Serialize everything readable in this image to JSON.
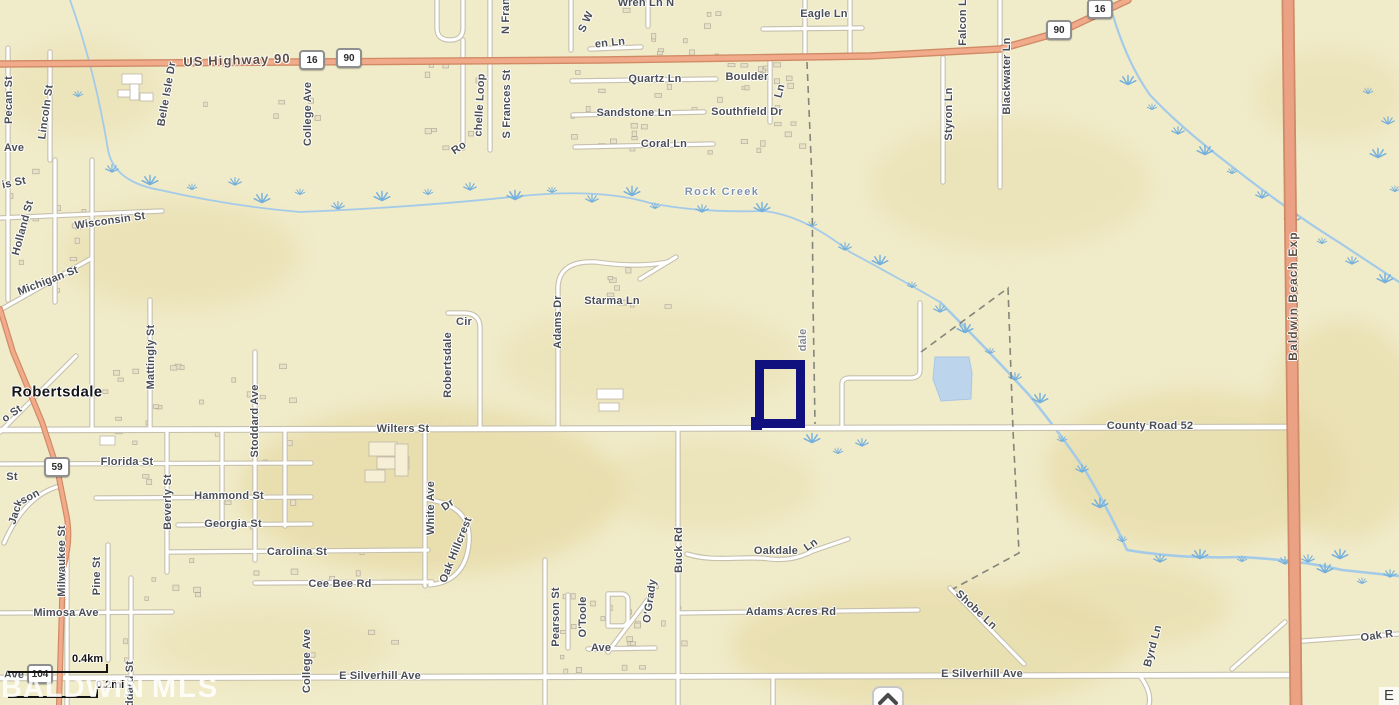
{
  "map": {
    "background_color": "#f0ebc9",
    "parcel_color": "#10107e",
    "pond_color": "#bdd4ed",
    "highway_color": "#f1ab8a",
    "labels": [
      {
        "t": "US Highway 90",
        "x": 237,
        "y": 60,
        "r": -2,
        "c": "hwy",
        "s": 13
      },
      {
        "t": "Pecan St",
        "x": 9,
        "y": 100,
        "r": -90
      },
      {
        "t": "Ave",
        "x": 14,
        "y": 148,
        "r": 0
      },
      {
        "t": "Lincoln St",
        "x": 46,
        "y": 112,
        "r": -82
      },
      {
        "t": "Belle Isle Dr",
        "x": 167,
        "y": 94,
        "r": -80
      },
      {
        "t": "is St",
        "x": 14,
        "y": 183,
        "r": -12
      },
      {
        "t": "Holland St",
        "x": 23,
        "y": 228,
        "r": -75
      },
      {
        "t": "Wisconsin St",
        "x": 110,
        "y": 221,
        "r": -8
      },
      {
        "t": "Michigan St",
        "x": 48,
        "y": 281,
        "r": -21
      },
      {
        "t": "College Ave",
        "x": 308,
        "y": 114,
        "r": -90
      },
      {
        "t": "College Ave",
        "x": 307,
        "y": 661,
        "r": -90
      },
      {
        "t": "Ro",
        "x": 459,
        "y": 148,
        "r": -35
      },
      {
        "t": "chelle Loop",
        "x": 480,
        "y": 105,
        "r": -87
      },
      {
        "t": "S Frances St",
        "x": 507,
        "y": 104,
        "r": -90
      },
      {
        "t": "N Fran",
        "x": 506,
        "y": 16,
        "r": -90
      },
      {
        "t": "S W",
        "x": 586,
        "y": 22,
        "r": -65
      },
      {
        "t": "en Ln",
        "x": 610,
        "y": 43,
        "r": -6
      },
      {
        "t": "Wren Ln N",
        "x": 646,
        "y": 3,
        "r": 0
      },
      {
        "t": "Eagle Ln",
        "x": 824,
        "y": 14,
        "r": 0
      },
      {
        "t": "Quartz Ln",
        "x": 655,
        "y": 79,
        "r": 0
      },
      {
        "t": "Boulder",
        "x": 747,
        "y": 77,
        "r": 0
      },
      {
        "t": "Ln",
        "x": 780,
        "y": 91,
        "r": -75
      },
      {
        "t": "Sandstone Ln",
        "x": 634,
        "y": 113,
        "r": 0
      },
      {
        "t": "Southfield Dr",
        "x": 747,
        "y": 112,
        "r": 0
      },
      {
        "t": "Coral Ln",
        "x": 664,
        "y": 144,
        "r": 0
      },
      {
        "t": "Styron Ln",
        "x": 949,
        "y": 114,
        "r": -90
      },
      {
        "t": "Blackwater Ln",
        "x": 1007,
        "y": 76,
        "r": -90
      },
      {
        "t": "Falcon Ln",
        "x": 963,
        "y": 19,
        "r": -90
      },
      {
        "t": "Rock Creek",
        "x": 722,
        "y": 192,
        "r": 0,
        "c": "water"
      },
      {
        "t": "Starma Ln",
        "x": 612,
        "y": 301,
        "r": 0
      },
      {
        "t": "Adams Dr",
        "x": 558,
        "y": 322,
        "r": -90
      },
      {
        "t": "Cir",
        "x": 464,
        "y": 322,
        "r": 0
      },
      {
        "t": "Robertsdale",
        "x": 448,
        "y": 365,
        "r": -90
      },
      {
        "t": "dale",
        "x": 803,
        "y": 340,
        "r": -90,
        "c": "faint"
      },
      {
        "t": "Wilters St",
        "x": 403,
        "y": 429,
        "r": 0
      },
      {
        "t": "County Road 52",
        "x": 1150,
        "y": 426,
        "r": 0
      },
      {
        "t": "Baldwin Beach Exp",
        "x": 1293,
        "y": 296,
        "r": -90,
        "c": "hwy",
        "s": 12
      },
      {
        "t": "Robertsdale",
        "x": 57,
        "y": 392,
        "r": 0,
        "c": "city",
        "s": 15
      },
      {
        "t": "o St",
        "x": 12,
        "y": 414,
        "r": -35
      },
      {
        "t": "St",
        "x": 12,
        "y": 477,
        "r": 0
      },
      {
        "t": "Florida St",
        "x": 127,
        "y": 462,
        "r": 0
      },
      {
        "t": "Mattingly St",
        "x": 151,
        "y": 357,
        "r": -90
      },
      {
        "t": "Stoddard Ave",
        "x": 255,
        "y": 421,
        "r": -90
      },
      {
        "t": "Beverly St",
        "x": 168,
        "y": 502,
        "r": -90
      },
      {
        "t": "Hammond St",
        "x": 229,
        "y": 496,
        "r": 0
      },
      {
        "t": "Georgia St",
        "x": 233,
        "y": 524,
        "r": 0
      },
      {
        "t": "Jack",
        "x": 16,
        "y": 512,
        "r": -72
      },
      {
        "t": "son",
        "x": 30,
        "y": 497,
        "r": -28
      },
      {
        "t": "Carolina St",
        "x": 297,
        "y": 552,
        "r": 0
      },
      {
        "t": "Cee Bee Rd",
        "x": 340,
        "y": 584,
        "r": 0
      },
      {
        "t": "Milwaukee St",
        "x": 62,
        "y": 561,
        "r": -90
      },
      {
        "t": "Pine St",
        "x": 97,
        "y": 576,
        "r": -90
      },
      {
        "t": "Mimosa Ave",
        "x": 66,
        "y": 613,
        "r": 0
      },
      {
        "t": "White Ave",
        "x": 431,
        "y": 508,
        "r": -90
      },
      {
        "t": "Oak Hillcrest",
        "x": 456,
        "y": 550,
        "r": -68
      },
      {
        "t": "Dr",
        "x": 448,
        "y": 505,
        "r": -35
      },
      {
        "t": "Pearson St",
        "x": 556,
        "y": 617,
        "r": -90
      },
      {
        "t": "O'Toole",
        "x": 583,
        "y": 617,
        "r": -90
      },
      {
        "t": "Ave",
        "x": 601,
        "y": 648,
        "r": 0
      },
      {
        "t": "O'Grady",
        "x": 650,
        "y": 601,
        "r": -82
      },
      {
        "t": "Buck Rd",
        "x": 679,
        "y": 550,
        "r": -90
      },
      {
        "t": "Oakdale",
        "x": 776,
        "y": 551,
        "r": 0
      },
      {
        "t": "Ln",
        "x": 811,
        "y": 545,
        "r": -35
      },
      {
        "t": "Adams Acres Rd",
        "x": 791,
        "y": 612,
        "r": 0
      },
      {
        "t": "Shobe Ln",
        "x": 976,
        "y": 610,
        "r": 43
      },
      {
        "t": "Byrd Ln",
        "x": 1153,
        "y": 646,
        "r": -75
      },
      {
        "t": "E Silverhill Ave",
        "x": 380,
        "y": 676,
        "r": 0
      },
      {
        "t": "E Silverhill Ave",
        "x": 982,
        "y": 674,
        "r": 0
      },
      {
        "t": "Oak R",
        "x": 1377,
        "y": 636,
        "r": -8
      },
      {
        "t": "ddard St",
        "x": 130,
        "y": 684,
        "r": -90
      },
      {
        "t": "Ave",
        "x": 14,
        "y": 675,
        "r": 0
      }
    ],
    "shields": [
      {
        "n": "16",
        "x": 312,
        "y": 60
      },
      {
        "n": "90",
        "x": 349,
        "y": 58
      },
      {
        "n": "90",
        "x": 1059,
        "y": 30
      },
      {
        "n": "16",
        "x": 1100,
        "y": 9
      },
      {
        "n": "59",
        "x": 57,
        "y": 467
      },
      {
        "n": "104",
        "x": 40,
        "y": 674
      }
    ],
    "scale_bar": {
      "km_label": "0.4km",
      "mi_label": "0.2mi"
    },
    "watermark": {
      "part1": "BALDWIN",
      "part2": "MLS"
    },
    "attribution": {
      "text": "E"
    },
    "pond": {
      "points": "935,357 969,357 972,373 971,399 941,401 933,379"
    },
    "marsh_points": [
      [
        78,
        95
      ],
      [
        112,
        170
      ],
      [
        150,
        182
      ],
      [
        192,
        188
      ],
      [
        235,
        183
      ],
      [
        262,
        200
      ],
      [
        300,
        193
      ],
      [
        338,
        207
      ],
      [
        382,
        198
      ],
      [
        428,
        193
      ],
      [
        470,
        188
      ],
      [
        515,
        197
      ],
      [
        552,
        191
      ],
      [
        592,
        200
      ],
      [
        632,
        193
      ],
      [
        655,
        207
      ],
      [
        702,
        210
      ],
      [
        762,
        209
      ],
      [
        812,
        225
      ],
      [
        845,
        248
      ],
      [
        880,
        262
      ],
      [
        912,
        286
      ],
      [
        940,
        310
      ],
      [
        965,
        330
      ],
      [
        990,
        352
      ],
      [
        1015,
        378
      ],
      [
        1040,
        400
      ],
      [
        1062,
        440
      ],
      [
        1082,
        470
      ],
      [
        1100,
        505
      ],
      [
        1122,
        540
      ],
      [
        1160,
        560
      ],
      [
        1200,
        556
      ],
      [
        1242,
        560
      ],
      [
        1285,
        562
      ],
      [
        1325,
        570
      ],
      [
        1362,
        582
      ],
      [
        1390,
        575
      ],
      [
        812,
        440
      ],
      [
        838,
        452
      ],
      [
        862,
        444
      ],
      [
        1128,
        82
      ],
      [
        1152,
        108
      ],
      [
        1178,
        132
      ],
      [
        1205,
        152
      ],
      [
        1232,
        172
      ],
      [
        1262,
        196
      ],
      [
        1292,
        220
      ],
      [
        1322,
        242
      ],
      [
        1352,
        262
      ],
      [
        1385,
        280
      ],
      [
        1368,
        92
      ],
      [
        1388,
        122
      ],
      [
        1378,
        155
      ],
      [
        1395,
        190
      ],
      [
        1308,
        560
      ],
      [
        1340,
        556
      ]
    ],
    "building_clusters": [
      {
        "x": 560,
        "y": 6,
        "w": 240,
        "h": 145,
        "n": 42
      },
      {
        "x": 598,
        "y": 250,
        "w": 75,
        "h": 55,
        "n": 9
      },
      {
        "x": 95,
        "y": 358,
        "w": 210,
        "h": 170,
        "n": 28
      },
      {
        "x": 118,
        "y": 548,
        "w": 280,
        "h": 110,
        "n": 16
      },
      {
        "x": 558,
        "y": 582,
        "w": 125,
        "h": 90,
        "n": 22
      },
      {
        "x": 425,
        "y": 62,
        "w": 55,
        "h": 85,
        "n": 8
      },
      {
        "x": 742,
        "y": 62,
        "w": 55,
        "h": 85,
        "n": 9
      },
      {
        "x": 5,
        "y": 162,
        "w": 95,
        "h": 135,
        "n": 12
      },
      {
        "x": 200,
        "y": 95,
        "w": 120,
        "h": 60,
        "n": 6
      }
    ],
    "terrain_patches": [
      {
        "x": 430,
        "y": 490,
        "rx": 190,
        "ry": 85,
        "o": 0.7
      },
      {
        "x": 180,
        "y": 255,
        "rx": 120,
        "ry": 55,
        "o": 0.45
      },
      {
        "x": 930,
        "y": 645,
        "rx": 200,
        "ry": 65,
        "o": 0.6
      },
      {
        "x": 1195,
        "y": 470,
        "rx": 150,
        "ry": 80,
        "o": 0.6
      },
      {
        "x": 1345,
        "y": 430,
        "rx": 80,
        "ry": 110,
        "o": 0.55
      },
      {
        "x": 1010,
        "y": 185,
        "rx": 140,
        "ry": 65,
        "o": 0.4
      },
      {
        "x": 650,
        "y": 360,
        "rx": 150,
        "ry": 55,
        "o": 0.35
      },
      {
        "x": 1330,
        "y": 95,
        "rx": 75,
        "ry": 45,
        "o": 0.4
      },
      {
        "x": 1120,
        "y": 605,
        "rx": 110,
        "ry": 45,
        "o": 0.5
      },
      {
        "x": 270,
        "y": 645,
        "rx": 120,
        "ry": 40,
        "o": 0.35
      },
      {
        "x": 705,
        "y": 485,
        "rx": 110,
        "ry": 45,
        "o": 0.4
      },
      {
        "x": 80,
        "y": 90,
        "rx": 80,
        "ry": 50,
        "o": 0.35
      }
    ]
  }
}
